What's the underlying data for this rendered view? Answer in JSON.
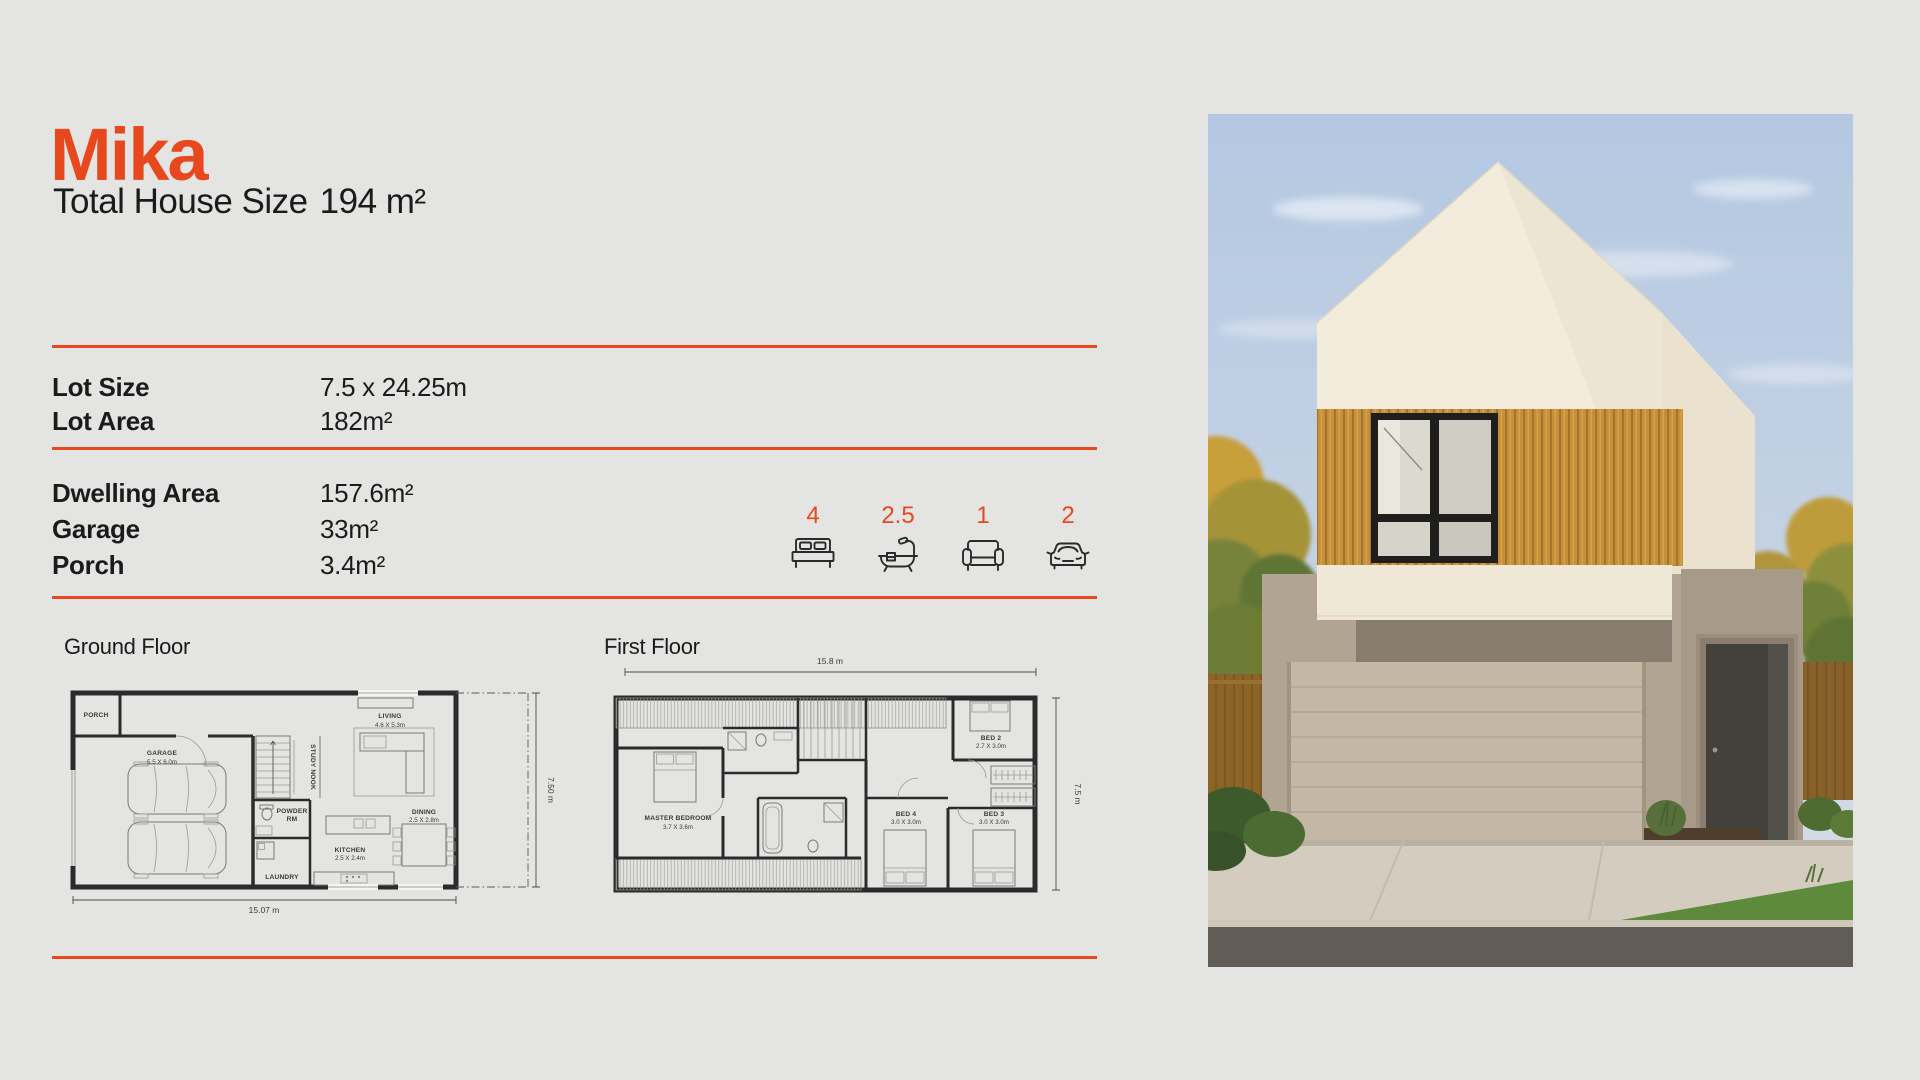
{
  "page": {
    "bg": "#E4E4E2",
    "accent": "#E8481D",
    "text_color": "#1B1B1B"
  },
  "header": {
    "title": "Mika",
    "total_label": "Total House Size",
    "total_value": "194 m²"
  },
  "lot_specs": [
    {
      "label": "Lot Size",
      "value": "7.5 x 24.25m"
    },
    {
      "label": "Lot Area",
      "value": "182m²"
    }
  ],
  "area_specs": [
    {
      "label": "Dwelling Area",
      "value": "157.6m²"
    },
    {
      "label": "Garage",
      "value": "33m²"
    },
    {
      "label": "Porch",
      "value": "3.4m²"
    }
  ],
  "features": [
    {
      "name": "bedrooms",
      "icon": "bed-icon",
      "count": "4"
    },
    {
      "name": "bathrooms",
      "icon": "bath-icon",
      "count": "2.5"
    },
    {
      "name": "living-rooms",
      "icon": "sofa-icon",
      "count": "1"
    },
    {
      "name": "car-spaces",
      "icon": "car-icon",
      "count": "2"
    }
  ],
  "ground_floor": {
    "title": "Ground Floor",
    "width_dim": "15.07 m",
    "depth_dim": "7.50 m",
    "rooms": [
      {
        "name": "PORCH"
      },
      {
        "name": "GARAGE",
        "size": "5.5 X 6.0m"
      },
      {
        "name": "STUDY NOOK"
      },
      {
        "name": "LIVING",
        "size": "4.6 X 5.3m"
      },
      {
        "name": "POWDER",
        "name2": "RM"
      },
      {
        "name": "KITCHEN",
        "size": "2.5 X 2.4m"
      },
      {
        "name": "LAUNDRY"
      },
      {
        "name": "DINING",
        "size": "2.5 X 2.8m"
      }
    ]
  },
  "first_floor": {
    "title": "First Floor",
    "width_dim": "15.8 m",
    "depth_dim": "7.5 m",
    "rooms": [
      {
        "name": "MASTER BEDROOM",
        "size": "3.7 X 3.6m"
      },
      {
        "name": "BED 2",
        "size": "2.7 X 3.0m"
      },
      {
        "name": "BED 4",
        "size": "3.0 X 3.0m"
      },
      {
        "name": "BED 3",
        "size": "3.0 X 3.0m"
      }
    ]
  },
  "photo": {
    "description": "house-exterior-render"
  }
}
